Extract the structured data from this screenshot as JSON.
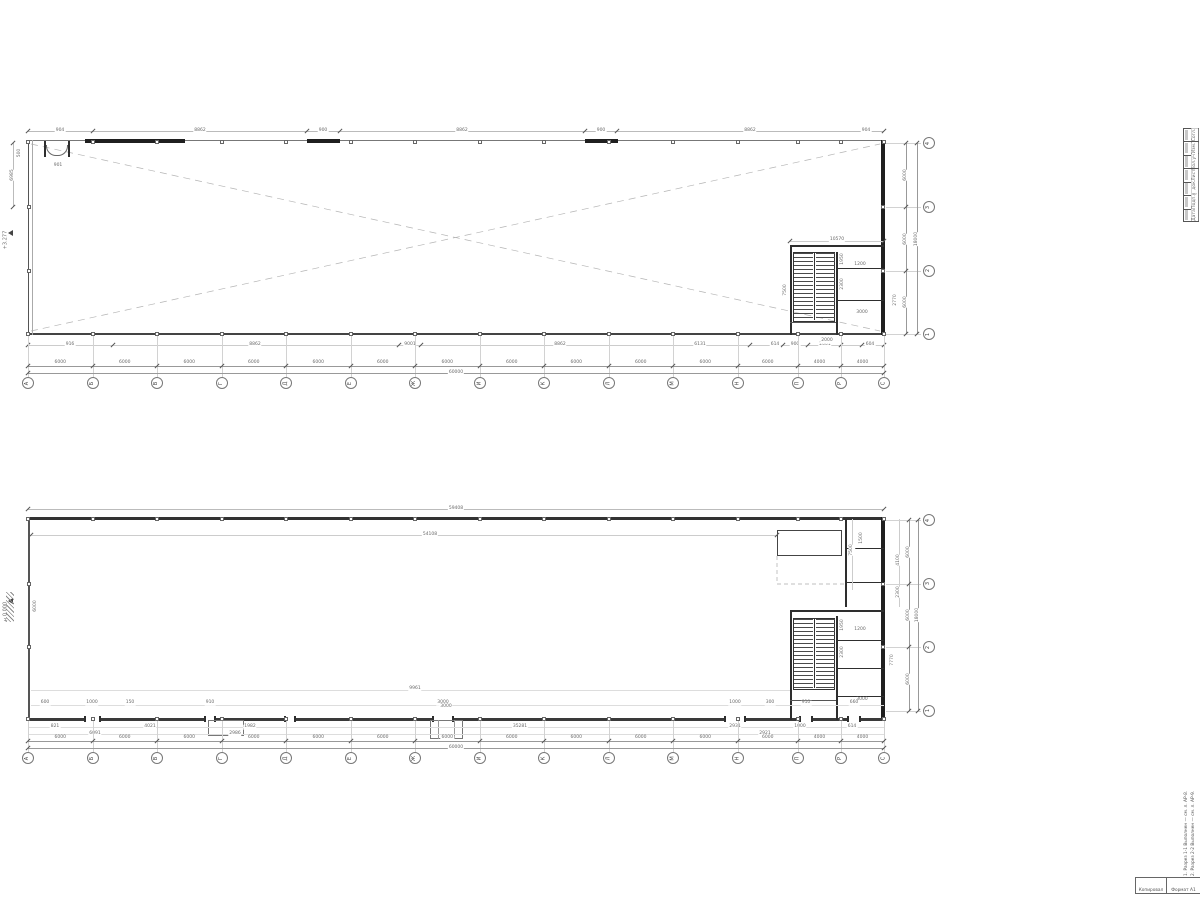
{
  "meta": {
    "elevation_upper": "+3.277",
    "elevation_lower": "±0.000",
    "left_dim_lower": "6000"
  },
  "axes": {
    "letters": [
      "А",
      "Б",
      "В",
      "Г",
      "Д",
      "Е",
      "Ж",
      "И",
      "К",
      "Л",
      "М",
      "Н",
      "П",
      "Р",
      "С"
    ],
    "numbers_bottom_to_top": [
      "1",
      "2",
      "3",
      "4"
    ],
    "gap_dims": [
      "6000",
      "6000",
      "6000",
      "6000",
      "6000",
      "6000",
      "6000",
      "6000",
      "6000",
      "6000",
      "6000",
      "6000",
      "4000",
      "4000"
    ],
    "side_gap_dims": [
      "6000",
      "6000",
      "6000"
    ],
    "total_width": "60000",
    "total_depth": "18000"
  },
  "plan_upper": {
    "top_dims": [
      "904",
      "8862",
      "900",
      "8862",
      "900",
      "8862",
      "904"
    ],
    "left_dims": [
      "6985",
      "901",
      "500"
    ],
    "bottom_chain": [
      "916",
      "8862",
      "9001",
      "8862",
      "6131",
      "614",
      "900",
      "2001",
      "604"
    ],
    "stair_dims": [
      "10570",
      "7500",
      "1950",
      "2300",
      "1200",
      "3000",
      "2770",
      "2000"
    ]
  },
  "plan_lower": {
    "top_total": "59408",
    "top_inner": "54108",
    "right_dims": [
      "7500",
      "4100",
      "2300",
      "1500",
      "7770"
    ],
    "stair_dims": [
      "1950",
      "2300",
      "1200",
      "3000"
    ],
    "inner_dim": "9961",
    "gate_dim": "3000",
    "inside_chain": [
      "600",
      "1000",
      "150",
      "910",
      "3000",
      "1000",
      "300",
      "910",
      "660"
    ],
    "below_chain": [
      "821",
      "4021",
      "1982",
      "35281",
      "2931",
      "1000",
      "614"
    ],
    "below_chain2": [
      "6091",
      "2986",
      "2921"
    ]
  },
  "stamp_strip": {
    "rows": [
      "Согл.",
      "Изм.",
      "Кол.уч",
      "Лист",
      "№ док.",
      "Подп.",
      "Дата"
    ]
  },
  "notes": [
    "1. Разрез 1-1 Выполнен — см. л. АР-8.",
    "2. Разрез 2-2 Выполнен — см. л. АР-9."
  ],
  "corner_table": {
    "cells": [
      "Копировал",
      "Формат А1"
    ]
  }
}
